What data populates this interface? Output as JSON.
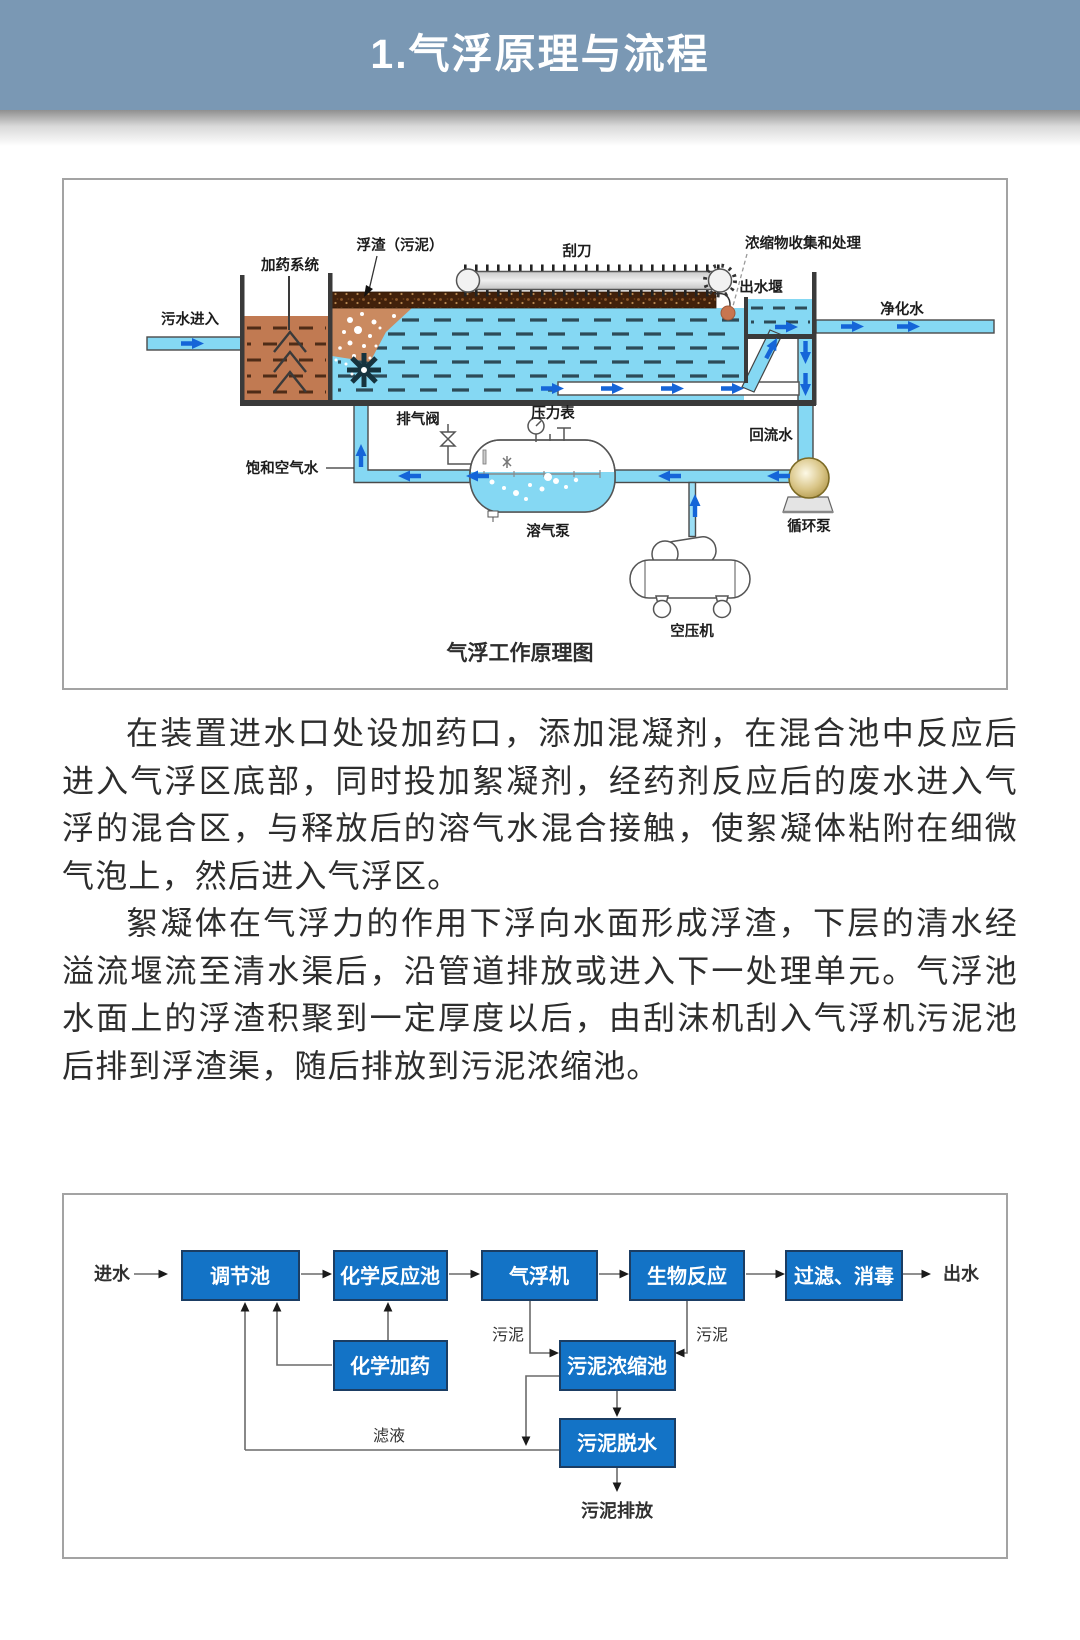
{
  "header": {
    "title": "1.气浮原理与流程"
  },
  "principle_figure": {
    "caption": "气浮工作原理图",
    "labels": {
      "sewage_inlet": "污水进入",
      "dosing_system": "加药系统",
      "scum": "浮渣（污泥）",
      "scraper": "刮刀",
      "concentrate_handling": "浓缩物收集和处理",
      "outlet_weir": "出水堰",
      "purified_water": "净化水",
      "saturated_air_water": "饱和空气水",
      "exhaust_valve": "排气阀",
      "pressure_gauge": "压力表",
      "return_water": "回流水",
      "dissolved_air_tank": "溶气泵",
      "circulation_pump": "循环泵",
      "air_compressor": "空压机"
    }
  },
  "body": {
    "paragraph1": "在装置进水口处设加药口，添加混凝剂，在混合池中反应后进入气浮区底部，同时投加絮凝剂，经药剂反应后的废水进入气浮的混合区，与释放后的溶气水混合接触，使絮凝体粘附在细微气泡上，然后进入气浮区。",
    "paragraph2": "絮凝体在气浮力的作用下浮向水面形成浮渣，下层的清水经溢流堰流至清水渠后，沿管道排放或进入下一处理单元。气浮池水面上的浮渣积聚到一定厚度以后，由刮沫机刮入气浮机污泥池后排到浮渣渠，随后排放到污泥浓缩池。"
  },
  "flowchart": {
    "inlet_label": "进水",
    "outlet_label": "出水",
    "nodes": {
      "regulating_tank": "调节池",
      "chemical_reaction_tank": "化学反应池",
      "daf_unit": "气浮机",
      "biological_reaction": "生物反应",
      "filtration_disinfection": "过滤、消毒",
      "chemical_dosing": "化学加药",
      "sludge_thickener": "污泥浓缩池",
      "sludge_dewatering": "污泥脱水"
    },
    "edge_labels": {
      "sludge_left": "污泥",
      "sludge_right": "污泥",
      "filtrate": "滤液",
      "sludge_discharge": "污泥排放"
    }
  },
  "colors": {
    "header_bg": "#7a98b4",
    "water_blue": "#85d8f3",
    "flow_box_blue": "#1373c6",
    "arrow_blue": "#1565d8",
    "mixing_brown": "#c17a52",
    "scum_brown": "#42210b"
  }
}
